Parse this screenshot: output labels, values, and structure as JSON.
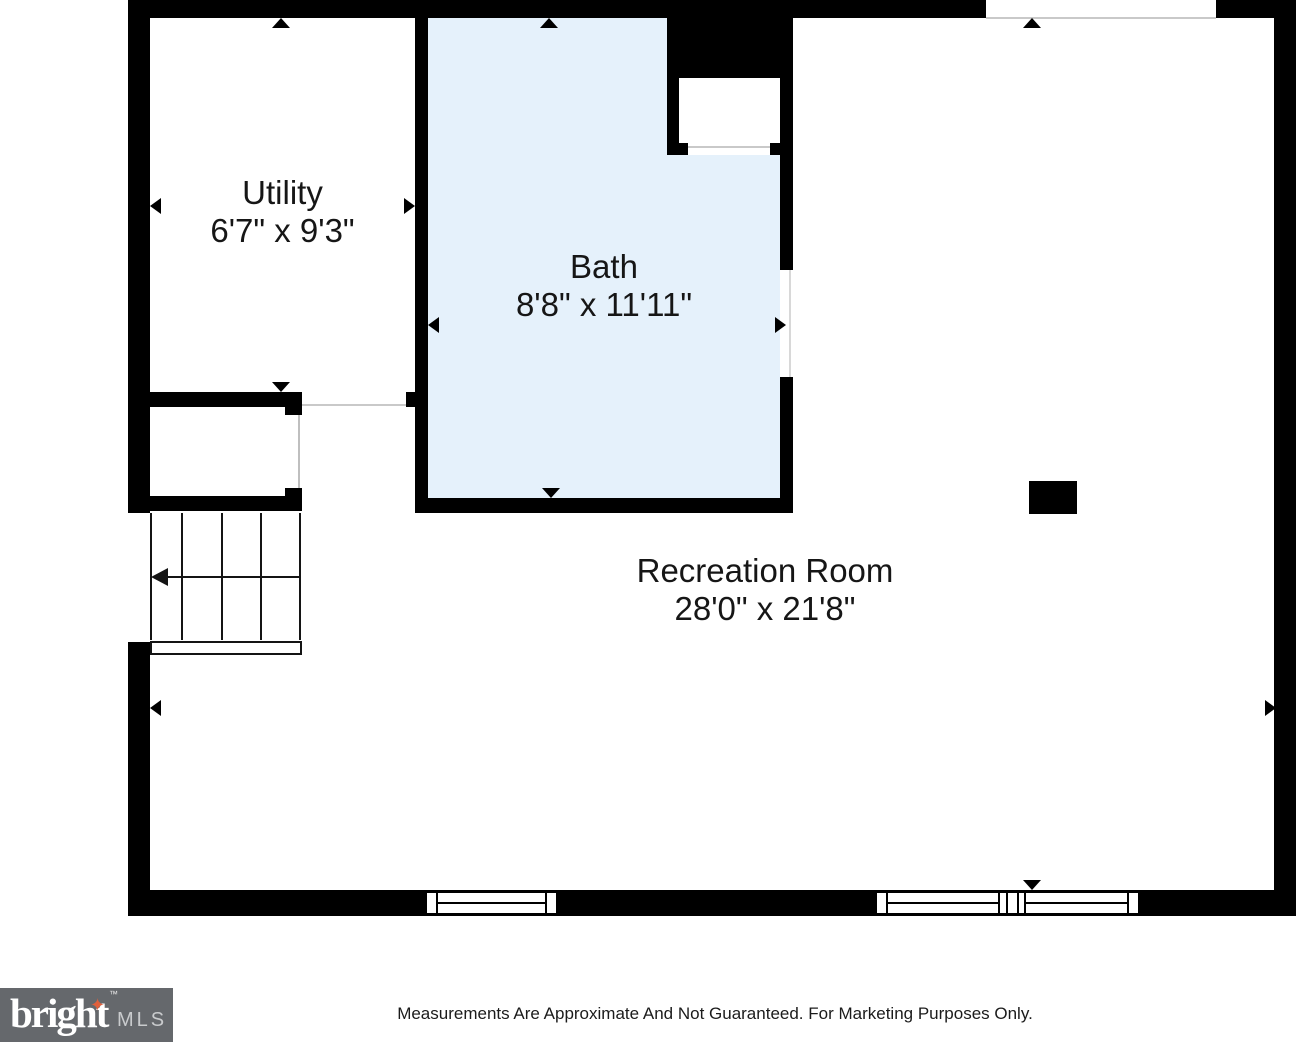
{
  "floor_plan": {
    "rooms": [
      {
        "name": "Utility",
        "dimensions": "6'7\" x 9'3\""
      },
      {
        "name": "Bath",
        "dimensions": "8'8\" x 11'11\""
      },
      {
        "name": "Recreation Room",
        "dimensions": "28'0\" x 21'8\""
      }
    ]
  },
  "footer": {
    "logo": {
      "brand": "bright",
      "suffix": "MLS",
      "trademark": "™",
      "star_icon": "✦"
    },
    "disclaimer": "Measurements Are Approximate And Not Guaranteed. For Marketing Purposes Only."
  },
  "colors": {
    "wall": "#000000",
    "bath_fill": "#e5f1fb",
    "opening_line": "#c9c9c9",
    "label_text": "#161616",
    "logo_background": "#65686c",
    "logo_text": "#ffffff",
    "logo_mls_text": "#c9cbcd",
    "logo_star": "#e0603c"
  }
}
